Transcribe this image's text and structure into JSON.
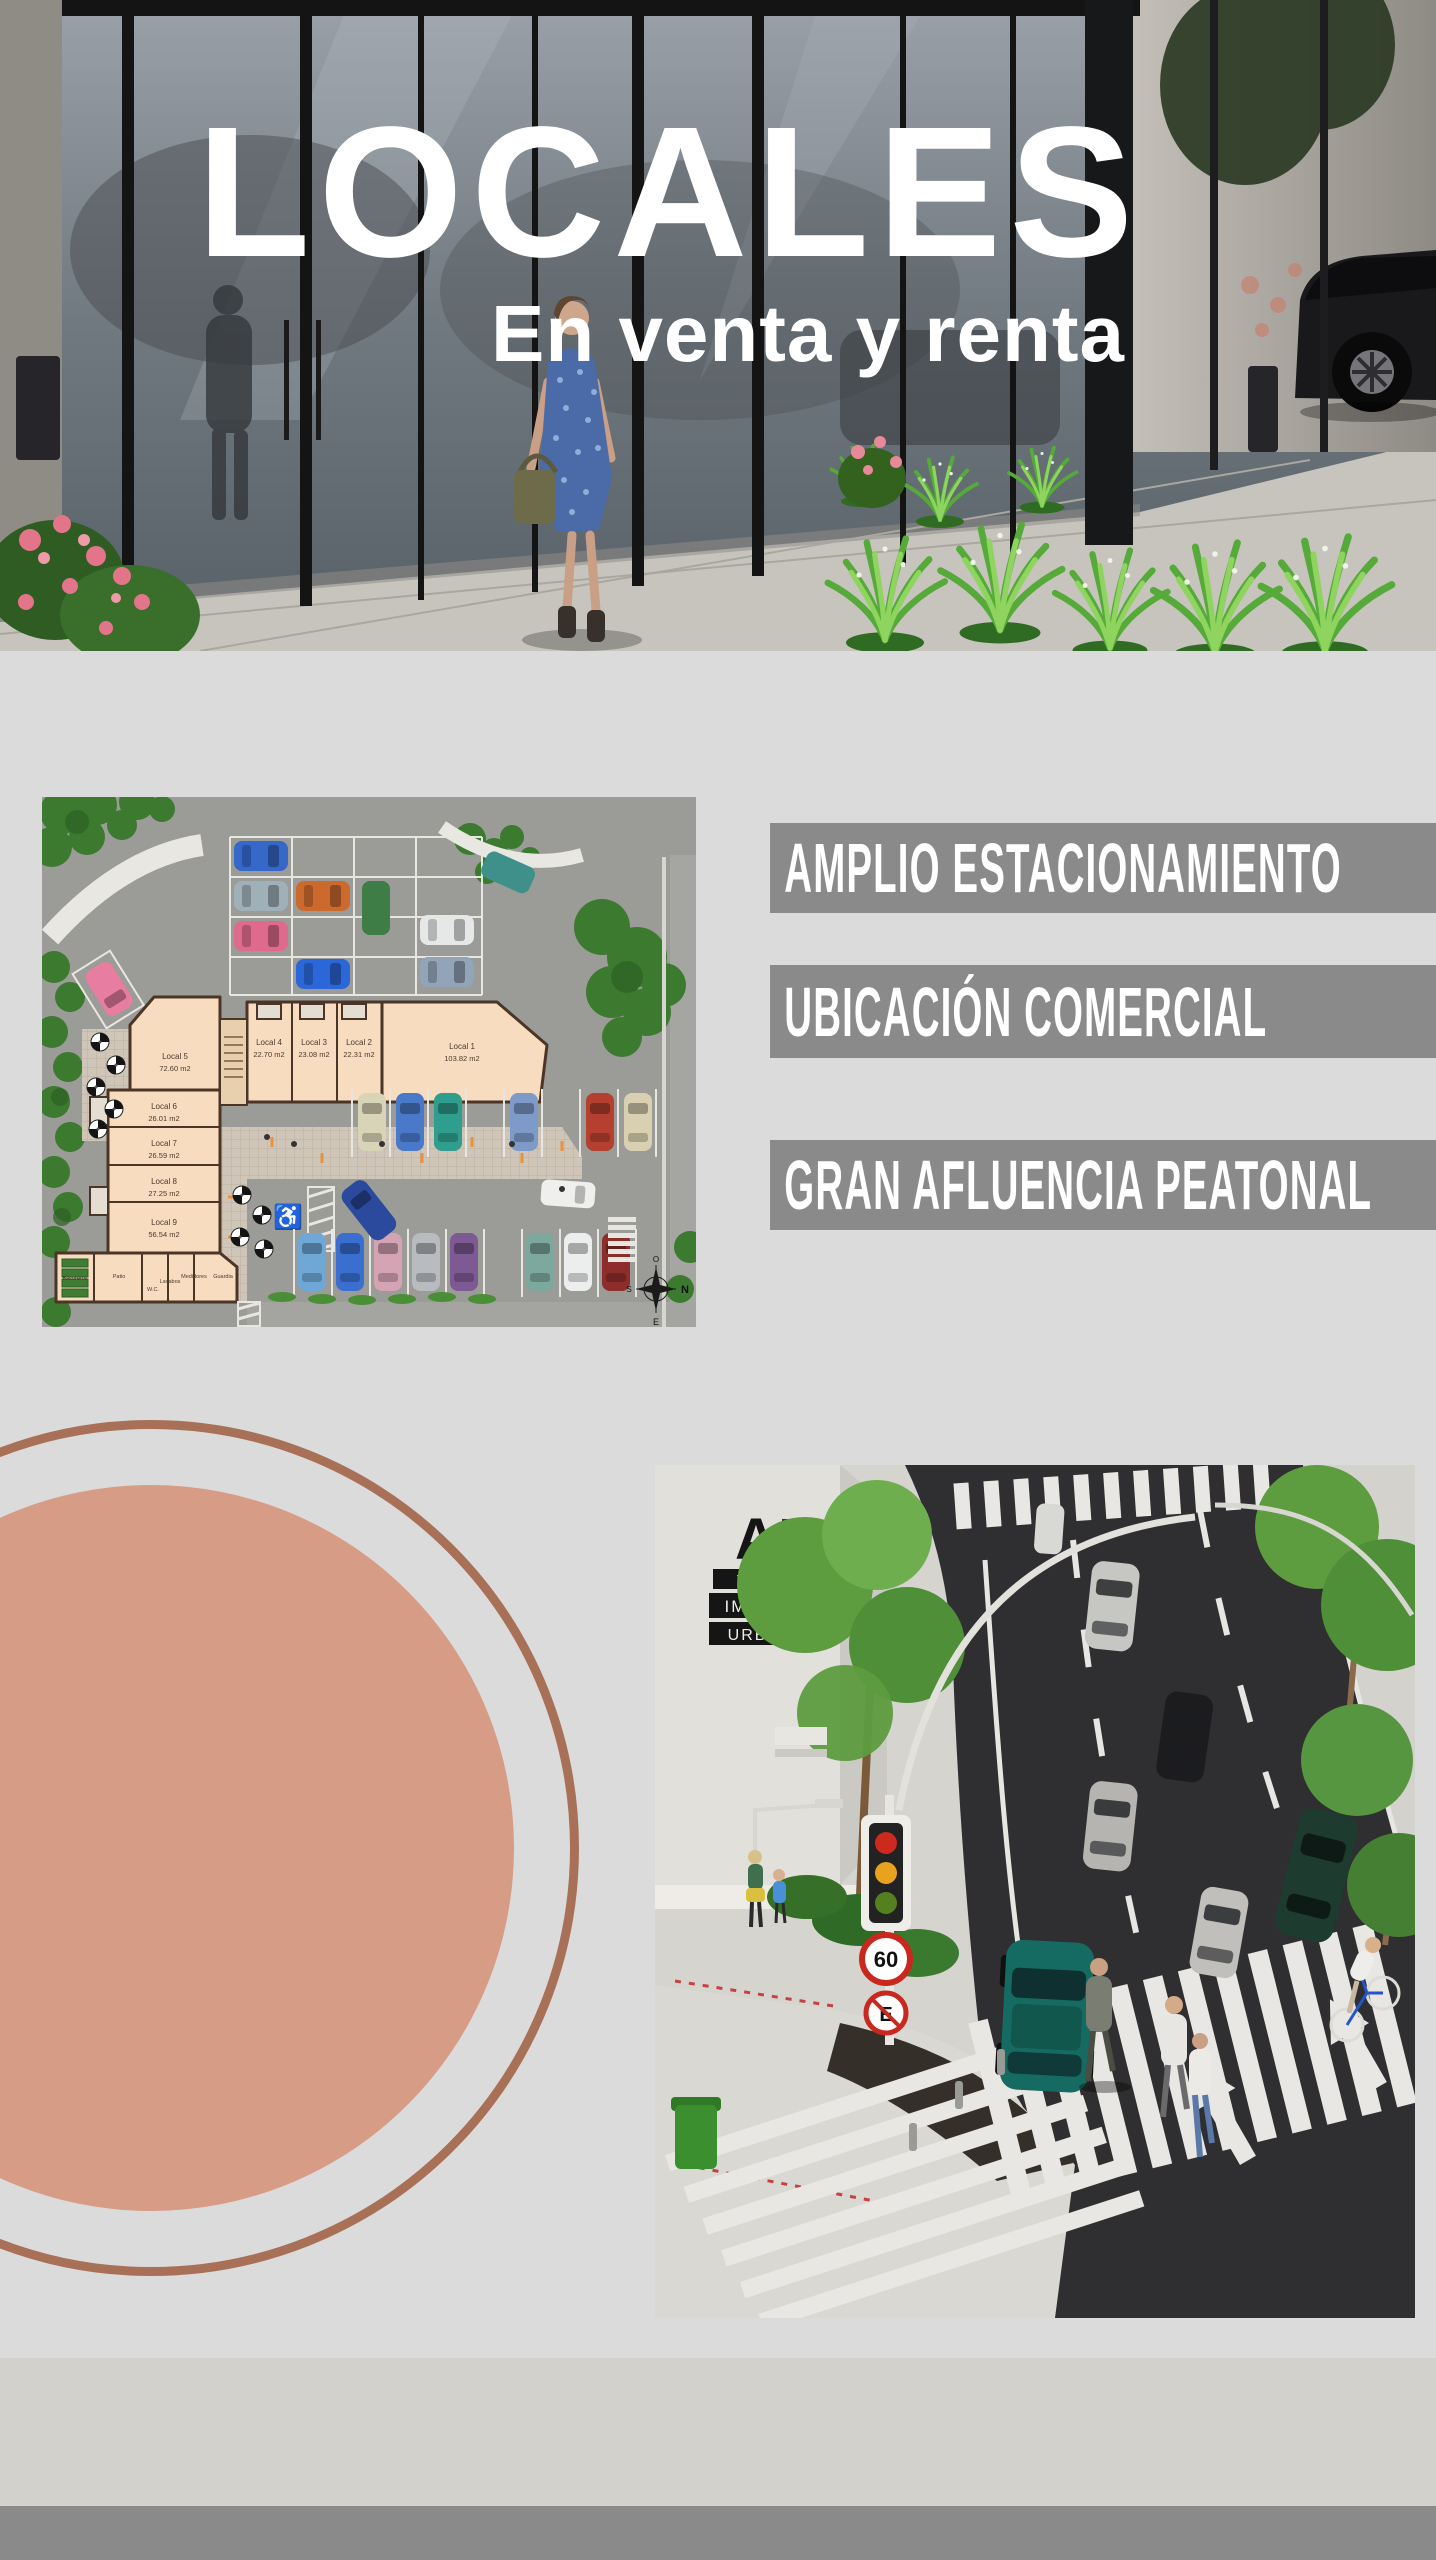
{
  "hero": {
    "title": "LOCALES",
    "subtitle": "En venta y renta"
  },
  "features": [
    "AMPLIO ESTACIONAMIENTO",
    "UBICACIÓN COMERCIAL",
    "GRAN AFLUENCIA PEATONAL"
  ],
  "site_plan": {
    "locals": [
      {
        "name": "Local 1",
        "area": "103.82 m2"
      },
      {
        "name": "Local 2",
        "area": "22.31 m2"
      },
      {
        "name": "Local 3",
        "area": "23.08 m2"
      },
      {
        "name": "Local 4",
        "area": "22.70 m2"
      },
      {
        "name": "Local 5",
        "area": "72.60 m2"
      },
      {
        "name": "Local 6",
        "area": "26.01 m2"
      },
      {
        "name": "Local 7",
        "area": "26.59 m2"
      },
      {
        "name": "Local 8",
        "area": "27.25 m2"
      },
      {
        "name": "Local 9",
        "area": "56.54 m2"
      }
    ],
    "rooms": [
      "Basureros",
      "Patio",
      "W.C.",
      "Lavabos",
      "Medidores",
      "Guardia"
    ],
    "compass": {
      "top": "O",
      "left": "S",
      "right": "N",
      "bottom": "E"
    },
    "accessible_icon": "♿"
  },
  "street_render": {
    "logo": {
      "monogram_a": "A",
      "monogram_v": "V",
      "lines": [
        "VALLARTA",
        "IMAGEN",
        "URBANA"
      ]
    },
    "signs": {
      "speed_limit": "60",
      "no_parking": "E"
    }
  },
  "colors": {
    "background": "#dcdbdb",
    "banner": "#8a8a8a",
    "banner_text": "#ffffff",
    "title_text": "#ffffff",
    "circle_fill": "#d69c86",
    "circle_ring": "#a87157",
    "footer_band": "#d3d1cb",
    "footer_bar": "#8a8a8a"
  }
}
